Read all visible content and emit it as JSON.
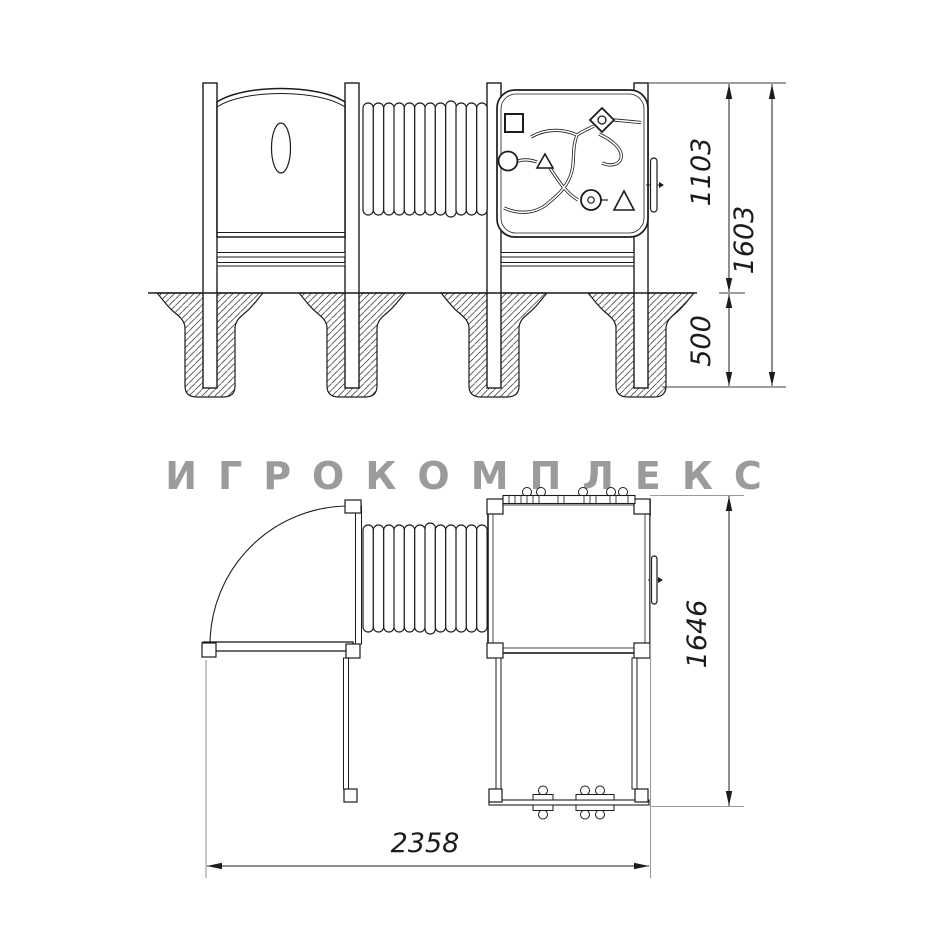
{
  "watermark": {
    "text": "ИГРОКОМПЛЕКС",
    "color": "#9b9b9b"
  },
  "drawing": {
    "type": "playground-equipment-technical-drawing",
    "line_color": "#1c1c1c",
    "extension_line_color": "#999999"
  },
  "dimensions": {
    "front_height_above_ground": "1103",
    "front_total_height": "1603",
    "front_foundation_depth": "500",
    "plan_depth": "1646",
    "plan_width": "2358"
  }
}
